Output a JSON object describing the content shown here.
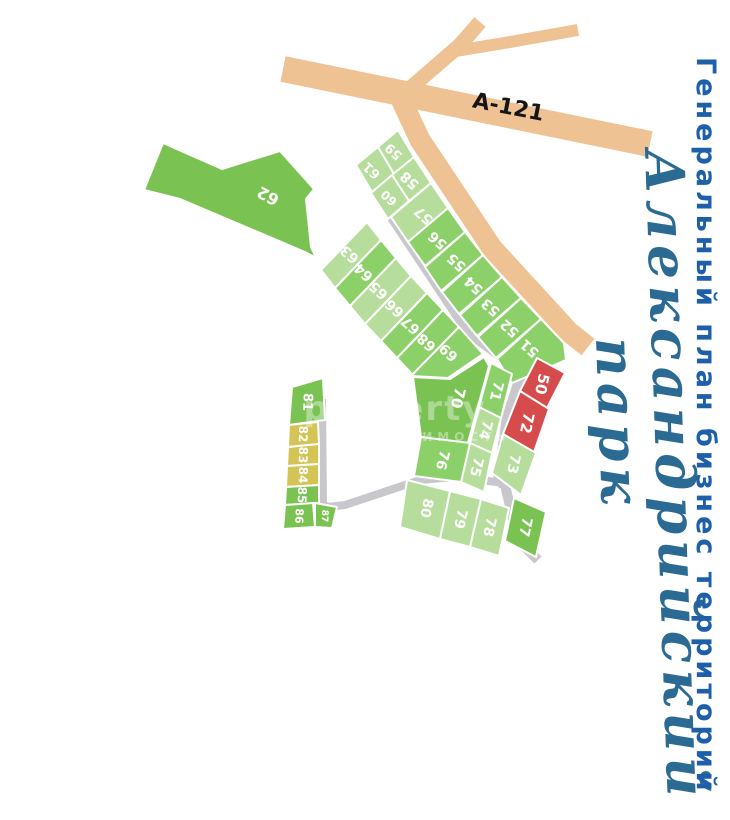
{
  "title": "Генеральный план бизнес территорий",
  "park": {
    "line1": "Александрийский",
    "line2": "парк"
  },
  "road_label": "А-121",
  "watermark": {
    "line1": "property",
    "line2": "НЕДВИЖИМОСТЬ"
  },
  "colors": {
    "tan": "#efc294",
    "gray": "#c8c7cc",
    "light": "#b6dd9b",
    "med": "#8cd069",
    "vivid": "#7ac353",
    "red": "#d64b4b",
    "yellow": "#d3c455",
    "label": "#ffffff",
    "title_blue": "#1d5fa9",
    "script_teal": "#2a6a93"
  },
  "roads": [
    {
      "name": "highway-a121",
      "color": "tan",
      "width": 26,
      "points": "283,69 650,144"
    },
    {
      "name": "north-branch",
      "color": "tan",
      "width": 15,
      "points": "400,97 460,45 480,22"
    },
    {
      "name": "northeast-branch",
      "color": "tan",
      "width": 12,
      "points": "450,52 510,42 578,30"
    },
    {
      "name": "southeast-road",
      "color": "tan",
      "width": 21,
      "points": "400,97 420,140 492,248 569,332 588,347"
    },
    {
      "name": "inner-road-spine",
      "color": "gray",
      "width": 13,
      "points": "381,178 394,218 470,332 492,348 523,372"
    },
    {
      "name": "east-road",
      "color": "gray",
      "width": 13,
      "points": "550,343 523,372 508,420 500,477 505,485"
    },
    {
      "name": "south-branch",
      "color": "gray",
      "width": 10,
      "points": "505,485 518,540 538,560"
    },
    {
      "name": "west-road",
      "color": "gray",
      "width": 8,
      "points": "505,483 455,477 420,480 345,505 328,507"
    },
    {
      "name": "left-loop-road",
      "color": "gray",
      "width": 8,
      "points": "322,399 323,505 330,507"
    }
  ],
  "plots": [
    {
      "id": "62",
      "color": "vivid",
      "points": "144,190 163,143 222,169 280,151 314,189 306,199 311,247 316,258 305,252 180,199",
      "label": {
        "x": 268,
        "y": 196,
        "rot": 208,
        "size": 16
      }
    },
    {
      "id": "59",
      "color": "light",
      "points": "398,130 414,157 394,174 378,147",
      "label": {
        "x": 394,
        "y": 151,
        "rot": 222,
        "size": 13
      }
    },
    {
      "id": "61",
      "color": "light",
      "points": "378,147 394,174 372,192 356,165",
      "label": {
        "x": 372,
        "y": 170,
        "rot": 222,
        "size": 13
      }
    },
    {
      "id": "58",
      "color": "light",
      "points": "414,157 431,183 409,201 392,175",
      "label": {
        "x": 410,
        "y": 180,
        "rot": 222,
        "size": 14
      }
    },
    {
      "id": "60",
      "color": "light",
      "points": "392,175 409,201 388,219 371,193",
      "label": {
        "x": 389,
        "y": 198,
        "rot": 222,
        "size": 12
      }
    },
    {
      "id": "57",
      "color": "light",
      "points": "431,183 448,208 408,242 391,217",
      "label": {
        "x": 424,
        "y": 215,
        "rot": 222,
        "size": 14
      }
    },
    {
      "id": "56",
      "color": "med",
      "points": "448,208 465,232 425,266 408,242",
      "label": {
        "x": 438,
        "y": 240,
        "rot": 222,
        "size": 14
      }
    },
    {
      "id": "55",
      "color": "med",
      "points": "465,232 483,255 441,291 425,267",
      "label": {
        "x": 457,
        "y": 262,
        "rot": 222,
        "size": 14
      }
    },
    {
      "id": "54",
      "color": "med",
      "points": "483,255 502,277 459,314 442,292",
      "label": {
        "x": 474,
        "y": 285,
        "rot": 222,
        "size": 14
      }
    },
    {
      "id": "53",
      "color": "med",
      "points": "502,277 521,298 477,336 460,315",
      "label": {
        "x": 491,
        "y": 307,
        "rot": 222,
        "size": 14
      }
    },
    {
      "id": "52",
      "color": "med",
      "points": "521,298 541,319 496,358 478,337",
      "label": {
        "x": 510,
        "y": 328,
        "rot": 222,
        "size": 14
      }
    },
    {
      "id": "51",
      "color": "med",
      "points": "541,319 564,343 566,360 512,383 497,359",
      "label": {
        "x": 530,
        "y": 348,
        "rot": 222,
        "size": 14
      }
    },
    {
      "id": "63",
      "color": "light",
      "points": "367,222 381,240 335,288 321,270",
      "label": {
        "x": 350,
        "y": 254,
        "rot": 222,
        "size": 14
      }
    },
    {
      "id": "64",
      "color": "med",
      "points": "381,240 396,258 350,306 335,288",
      "label": {
        "x": 364,
        "y": 272,
        "rot": 222,
        "size": 14
      }
    },
    {
      "id": "65",
      "color": "light",
      "points": "396,258 411,276 365,324 350,306",
      "label": {
        "x": 379,
        "y": 290,
        "rot": 222,
        "size": 14
      }
    },
    {
      "id": "66",
      "color": "light",
      "points": "411,276 427,293 381,341 365,324",
      "label": {
        "x": 395,
        "y": 308,
        "rot": 222,
        "size": 14
      }
    },
    {
      "id": "67",
      "color": "med",
      "points": "427,293 443,310 397,358 381,341",
      "label": {
        "x": 411,
        "y": 325,
        "rot": 222,
        "size": 14
      }
    },
    {
      "id": "68",
      "color": "med",
      "points": "443,310 459,327 413,375 397,358",
      "label": {
        "x": 427,
        "y": 342,
        "rot": 222,
        "size": 14
      }
    },
    {
      "id": "69",
      "color": "med",
      "points": "459,327 483,354 448,378 411,376",
      "label": {
        "x": 449,
        "y": 352,
        "rot": 222,
        "size": 14
      }
    },
    {
      "id": "70",
      "color": "vivid",
      "points": "413,377 450,379 484,357 489,366 477,410 467,446 421,437",
      "label": {
        "x": 458,
        "y": 398,
        "rot": 104,
        "size": 15
      }
    },
    {
      "id": "71",
      "color": "med",
      "points": "491,363 512,374 501,418 479,407",
      "label": {
        "x": 496,
        "y": 391,
        "rot": 104,
        "size": 14
      }
    },
    {
      "id": "74",
      "color": "light",
      "points": "479,407 501,418 492,453 470,443",
      "label": {
        "x": 485,
        "y": 430,
        "rot": 104,
        "size": 14
      }
    },
    {
      "id": "75",
      "color": "light",
      "points": "470,443 492,453 484,492 461,482",
      "label": {
        "x": 476,
        "y": 467,
        "rot": 104,
        "size": 14
      }
    },
    {
      "id": "76",
      "color": "med",
      "points": "421,437 470,443 461,482 414,476",
      "label": {
        "x": 442,
        "y": 460,
        "rot": 104,
        "size": 14
      }
    },
    {
      "id": "50",
      "color": "red",
      "points": "537,358 565,373 546,410 520,391",
      "label": {
        "x": 542,
        "y": 384,
        "rot": 102,
        "size": 15
      }
    },
    {
      "id": "72",
      "color": "red",
      "points": "520,391 549,409 533,455 503,434",
      "label": {
        "x": 527,
        "y": 423,
        "rot": 102,
        "size": 15
      }
    },
    {
      "id": "73",
      "color": "light",
      "points": "503,434 536,453 521,495 492,473",
      "label": {
        "x": 513,
        "y": 464,
        "rot": 102,
        "size": 14
      }
    },
    {
      "id": "77",
      "color": "vivid",
      "points": "514,498 546,512 536,557 505,541",
      "label": {
        "x": 525,
        "y": 527,
        "rot": 102,
        "size": 14
      }
    },
    {
      "id": "78",
      "color": "light",
      "points": "481,499 509,508 499,556 470,547",
      "label": {
        "x": 489,
        "y": 527,
        "rot": 102,
        "size": 14
      }
    },
    {
      "id": "79",
      "color": "light",
      "points": "450,491 481,499 470,547 440,539",
      "label": {
        "x": 460,
        "y": 519,
        "rot": 102,
        "size": 14
      }
    },
    {
      "id": "80",
      "color": "light",
      "points": "407,480 450,491 440,539 400,527",
      "label": {
        "x": 426,
        "y": 508,
        "rot": 102,
        "size": 14
      }
    },
    {
      "id": "81",
      "color": "vivid",
      "points": "292,387 323,378 325,420 289,425",
      "label": {
        "x": 307,
        "y": 402,
        "rot": 92,
        "size": 13
      }
    },
    {
      "id": "82",
      "color": "yellow",
      "points": "289,425 318,422 319,444 288,447",
      "label": {
        "x": 303,
        "y": 434,
        "rot": 92,
        "size": 12
      }
    },
    {
      "id": "83",
      "color": "yellow",
      "points": "288,447 319,444 319,464 287,466",
      "label": {
        "x": 303,
        "y": 455,
        "rot": 92,
        "size": 12
      }
    },
    {
      "id": "84",
      "color": "yellow",
      "points": "287,466 319,464 319,485 286,487",
      "label": {
        "x": 303,
        "y": 475,
        "rot": 92,
        "size": 12
      }
    },
    {
      "id": "85",
      "color": "vivid",
      "points": "286,487 319,485 319,503 285,505",
      "label": {
        "x": 302,
        "y": 495,
        "rot": 92,
        "size": 12
      }
    },
    {
      "id": "86",
      "color": "vivid",
      "points": "285,505 313,503 315,527 283,529",
      "label": {
        "x": 299,
        "y": 516,
        "rot": 92,
        "size": 11
      }
    },
    {
      "id": "87",
      "color": "vivid",
      "points": "315,503 337,507 332,528 315,527",
      "label": {
        "x": 324,
        "y": 516,
        "rot": 92,
        "size": 9
      }
    }
  ]
}
